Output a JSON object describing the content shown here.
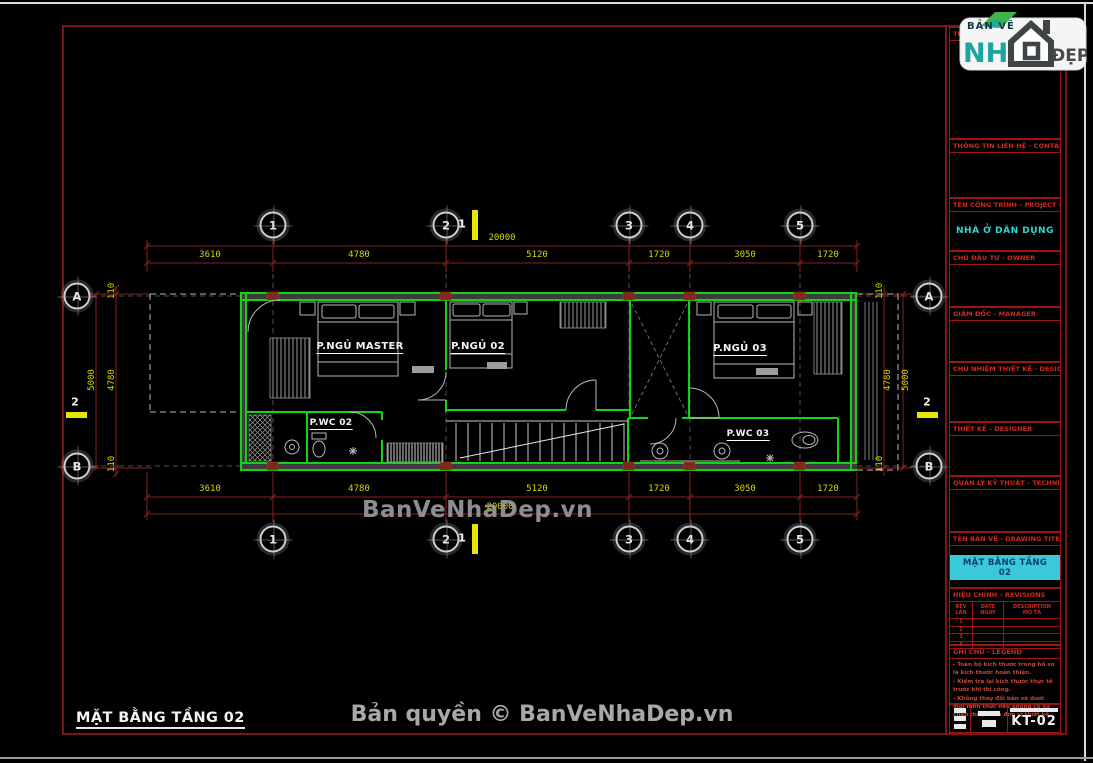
{
  "page": {
    "watermark": "BanVeNhaDep.vn",
    "copyright": "Bản quyền © BanVeNhaDep.vn",
    "footer_title": "MẶT BẰNG TẦNG 02"
  },
  "logo": {
    "tagline": "BẢN VẼ",
    "word_left": "NH",
    "word_right": "ĐẸP"
  },
  "title_block": {
    "sections": [
      {
        "label": "TƯ VẤN - CONSULTANT"
      },
      {
        "label": "THÔNG TIN LIÊN HỆ - CONTACT INFO"
      },
      {
        "label": "TÊN CÔNG TRÌNH - PROJECT NAME",
        "value": "NHÀ Ở DÂN DỤNG"
      },
      {
        "label": "CHỦ ĐẦU TƯ - OWNER"
      },
      {
        "label": "GIÁM ĐỐC - MANAGER"
      },
      {
        "label": "CHỦ NHIỆM THIẾT KẾ - DESIGN MANAGER"
      },
      {
        "label": "THIẾT KẾ - DESIGNER"
      },
      {
        "label": "QUẢN LÝ KỸ THUẬT - TECHNICAL MANAGER"
      },
      {
        "label": "TÊN BẢN VẼ - DRAWING TITEL",
        "value": "MẶT BẰNG TẦNG 02"
      },
      {
        "label": "HIỆU CHỈNH - REVISIONS"
      },
      {
        "label": "GHI CHÚ - LEGEND"
      }
    ],
    "revisions": {
      "col1_line1": "REV",
      "col1_line2": "LẦN",
      "col2_line1": "DATE",
      "col2_line2": "NGÀY",
      "col3_line1": "DESCRIPTION",
      "col3_line2": "MÔ TẢ",
      "rows": [
        "1",
        "2",
        "3",
        "4"
      ]
    },
    "notes": [
      "- Toàn bộ kích thước trong hồ sơ là kích thước hoàn thiện.",
      "- Kiểm tra lại kích thước thực tế trước khi thi công.",
      "- Không thay đổi bản vẽ dưới mọi hình thức nếu không có sự chấp thuận của đơn vị thiết kế."
    ],
    "sheet_number": "KT-02"
  },
  "plan": {
    "grid_cols": [
      "1",
      "2",
      "3",
      "4",
      "5"
    ],
    "grid_rows": [
      "A",
      "B"
    ],
    "section_markers": [
      "1",
      "2"
    ],
    "dims_top": [
      "3610",
      "4780",
      "5120",
      "1720",
      "3050",
      "1720"
    ],
    "dims_total": "20000",
    "dims_side": [
      "110",
      "4780",
      "110"
    ],
    "dims_side_total": "5000",
    "rooms": {
      "master": "P.NGỦ MASTER",
      "bed2": "P.NGỦ 02",
      "bed3": "P.NGỦ 03",
      "wc2": "P.WC 02",
      "wc3": "P.WC 03"
    }
  }
}
